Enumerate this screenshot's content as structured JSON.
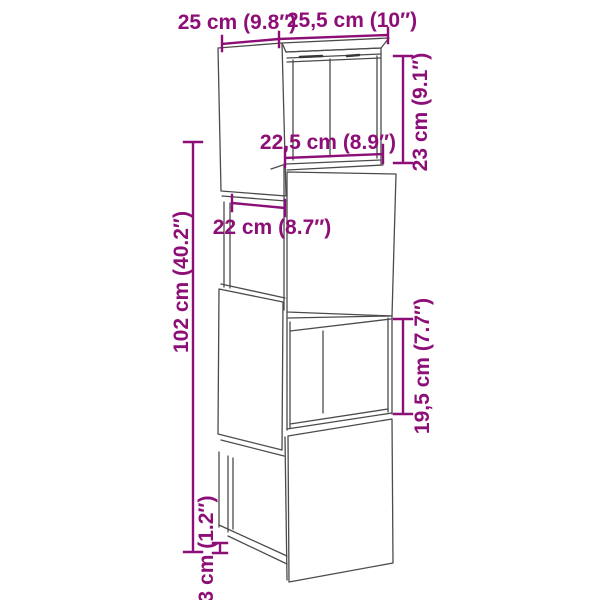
{
  "diagram": {
    "subject": "tall 4-cube modular cabinet line drawing",
    "colors": {
      "dimension": "#8C0E76",
      "outline": "#4B4B4B",
      "background": "#FFFFFF"
    },
    "measurements": {
      "top_width": {
        "label": "25 cm (9.8″)",
        "cm": 25,
        "inches": 9.8,
        "orientation": "horizontal"
      },
      "top_depth": {
        "label": "25,5 cm (10″)",
        "cm": 25.5,
        "inches": 10,
        "orientation": "horizontal"
      },
      "upper_module_height": {
        "label": "23 cm (9.1″)",
        "cm": 23,
        "inches": 9.1,
        "orientation": "vertical"
      },
      "upper_opening_width": {
        "label": "22,5 cm (8.9″)",
        "cm": 22.5,
        "inches": 8.9,
        "orientation": "horizontal"
      },
      "side_opening_depth": {
        "label": "22 cm (8.7″)",
        "cm": 22,
        "inches": 8.7,
        "orientation": "horizontal"
      },
      "total_height": {
        "label": "102 cm (40.2″)",
        "cm": 102,
        "inches": 40.2,
        "orientation": "vertical"
      },
      "lower_opening_height": {
        "label": "19,5 cm (7.7″)",
        "cm": 19.5,
        "inches": 7.7,
        "orientation": "vertical"
      },
      "base_height": {
        "label": "3 cm (1.2″)",
        "cm": 3,
        "inches": 1.2,
        "orientation": "vertical"
      }
    }
  }
}
